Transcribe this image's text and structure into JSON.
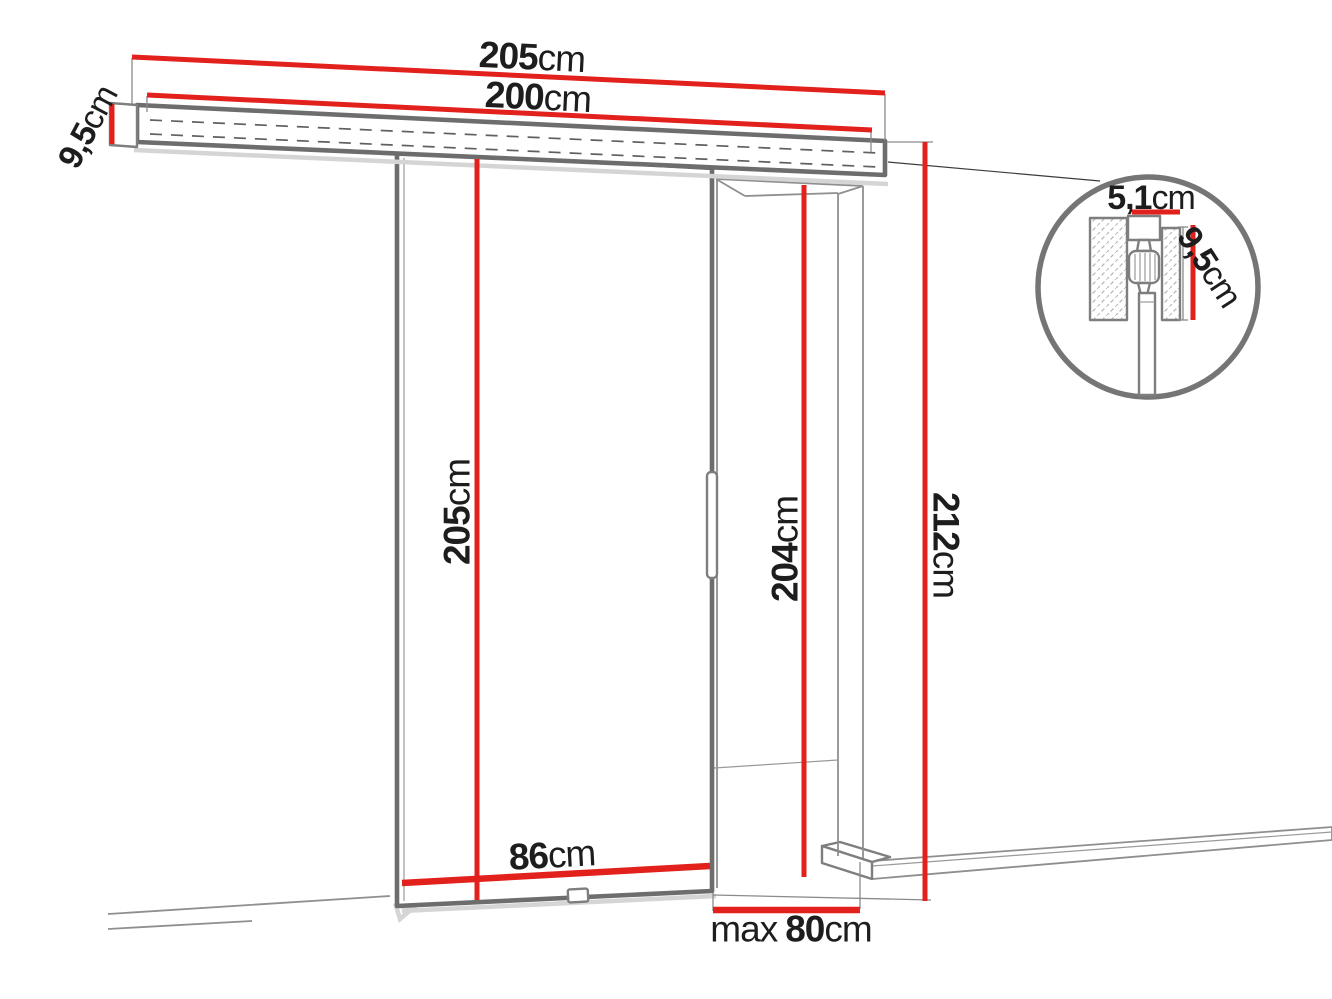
{
  "diagram": {
    "type": "product-dimension-diagram",
    "subject": "sliding-door-system"
  },
  "labels": {
    "track_total_width": {
      "value": "205",
      "unit": "cm"
    },
    "track_length": {
      "value": "200",
      "unit": "cm"
    },
    "track_side_height": {
      "value": "9,5",
      "unit": "cm"
    },
    "door_height": {
      "value": "205",
      "unit": "cm"
    },
    "opening_height": {
      "value": "204",
      "unit": "cm"
    },
    "overall_height": {
      "value": "212",
      "unit": "cm"
    },
    "door_width": {
      "value": "86",
      "unit": "cm"
    },
    "max_opening_width": {
      "prefix": "max",
      "value": "80",
      "unit": "cm"
    },
    "detail_width": {
      "value": "5,1",
      "unit": "cm"
    },
    "detail_height": {
      "value": "9,5",
      "unit": "cm"
    }
  },
  "colors": {
    "dimension_red": "#e2201c",
    "outline_gray": "#6d6d6d",
    "text_dark": "#1d1d1d"
  }
}
